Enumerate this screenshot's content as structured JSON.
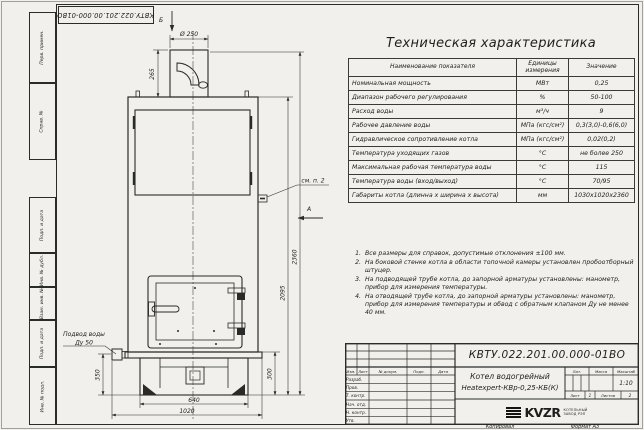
{
  "doc_number": "КВТУ.022.201.00.000-01ВО",
  "margin": {
    "perv_primen": "Перв. примен.",
    "sprav_no": "Справ. №",
    "podp_data_1": "Подп. и дата",
    "inv_dubl": "Инв. № дубл.",
    "vzam_inv": "Взам. инв. №",
    "podp_data_2": "Подп. и дата",
    "inv_podl": "Инв. № подл."
  },
  "drawing": {
    "view_b": "Б",
    "view_a": "А",
    "dims": {
      "d250": "Ø 250",
      "h265": "265",
      "h350": "350",
      "h300": "300",
      "w640": "640",
      "w1020": "1020",
      "h2095": "2095",
      "h2360": "2360"
    },
    "callout_note": "см. п. 2",
    "water_line1": "Подвод воды",
    "water_line2": "Ду 50"
  },
  "spec_table": {
    "title": "Техническая характеристика",
    "headers": [
      "Наименование показателя",
      "Единицы измерения",
      "Значение"
    ],
    "rows": [
      [
        "Номинальная мощность",
        "МВт",
        "0,25"
      ],
      [
        "Диапазон рабочего регулирования",
        "%",
        "50-100"
      ],
      [
        "Расход воды",
        "м³/ч",
        "9"
      ],
      [
        "Рабочее давление воды",
        "МПа (кгс/см²)",
        "0,3(3,0)-0,6(6,0)"
      ],
      [
        "Гидравлическое сопротивление котла",
        "МПа (кгс/см²)",
        "0,02(0,2)"
      ],
      [
        "Температура уходящих газов",
        "°С",
        "не более 250"
      ],
      [
        "Максимальная рабочая температура воды",
        "°С",
        "115"
      ],
      [
        "Температура воды (вход/выход)",
        "°С",
        "70/95"
      ],
      [
        "Габариты котла (длинна х ширина х высота)",
        "мм",
        "1030х1020х2360"
      ]
    ]
  },
  "notes": {
    "items": [
      {
        "num": "1.",
        "text": "Все размеры для справок, допустимые отклонения ±100 мм."
      },
      {
        "num": "2.",
        "text": "На боковой стенке котла в области топочной камеры установлен пробоотборный штуцер."
      },
      {
        "num": "3.",
        "text": "На подводящей трубе котла, до запорной арматуры установлены: манометр, прибор для измерения температуры."
      },
      {
        "num": "4.",
        "text": "На отводящей трубе котла, до запорной арматуры установлены: манометр, прибор для измерения температуры и обвод с обратным клапаном Ду не менее 40 мм."
      }
    ]
  },
  "title_block": {
    "cols": [
      "Изм.",
      "Лист",
      "№ докум.",
      "Подп.",
      "Дата"
    ],
    "rows": [
      "Разраб.",
      "Пров.",
      "Т. контр.",
      "Нач. отд.",
      "Н. контр.",
      "Утв."
    ],
    "name_line1": "Котел водогрейный",
    "name_line2": "Heatexpert-КВр-0,25-КБ(К)",
    "lit_label": "Лит.",
    "mass_label": "Масса",
    "scale_label": "Масштаб",
    "scale_value": "1:10",
    "sheet_label": "Лист",
    "sheet_value": "1",
    "sheets_label": "Листов",
    "sheets_value": "2",
    "logo_text": "KVZR",
    "logo_sub1": "КОТЕЛЬНЫЙ",
    "logo_sub2": "ЗАВОД РЭП"
  },
  "footer": {
    "copied": "Копировал",
    "format": "Формат А3"
  }
}
